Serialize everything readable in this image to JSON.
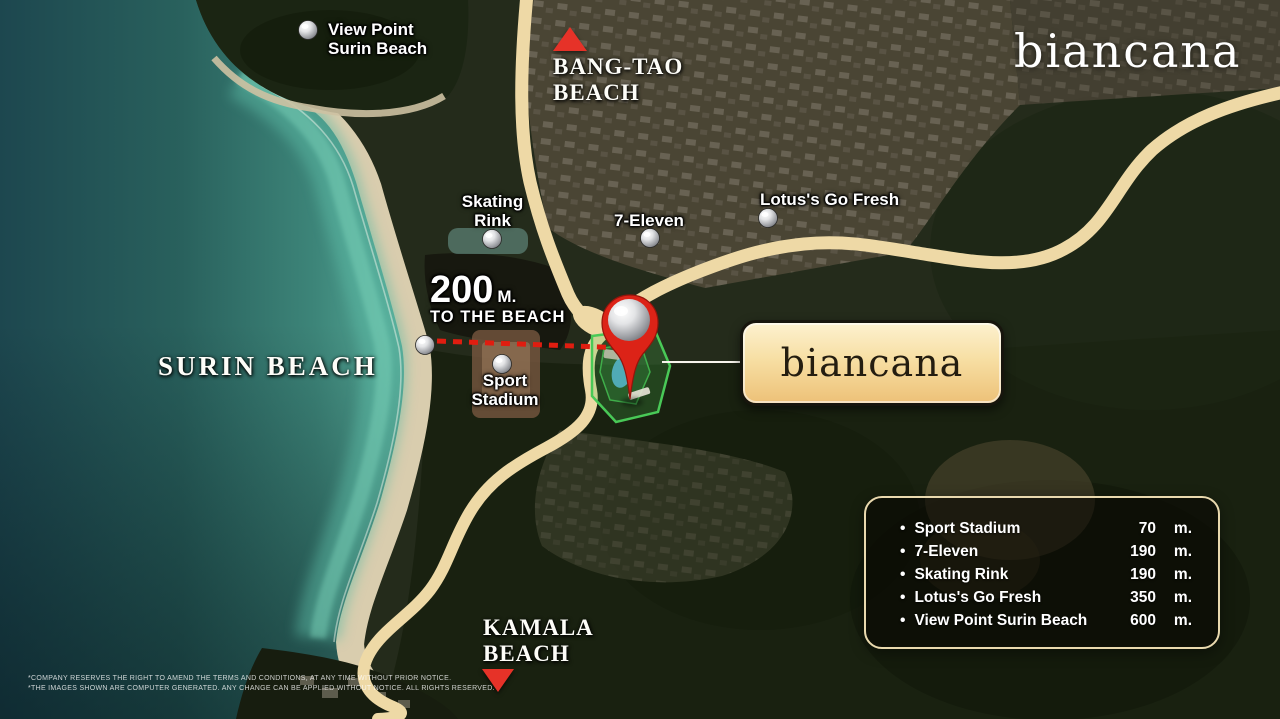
{
  "brand": {
    "logo_text": "biancana"
  },
  "map": {
    "labels": {
      "view_point": {
        "line1": "View Point",
        "line2": "Surin Beach"
      },
      "bang_tao": {
        "line1": "BANG-TAO",
        "line2": "BEACH"
      },
      "skating_rink": {
        "line1": "Skating",
        "line2": "Rink"
      },
      "seven_eleven": {
        "text": "7-Eleven"
      },
      "lotus": {
        "text": "Lotus's Go Fresh"
      },
      "surin_beach": {
        "text": "SURIN BEACH"
      },
      "sport_stadium": {
        "line1": "Sport",
        "line2": "Stadium"
      },
      "kamala": {
        "line1": "KAMALA",
        "line2": "BEACH"
      }
    },
    "beach_callout": {
      "value": "200",
      "unit": "M.",
      "caption": "TO THE BEACH"
    },
    "property_sign": {
      "text": "biancana"
    }
  },
  "distance_panel": {
    "items": [
      {
        "name": "Sport Stadium",
        "value": "70",
        "unit": "m."
      },
      {
        "name": "7-Eleven",
        "value": "190",
        "unit": "m."
      },
      {
        "name": "Skating Rink",
        "value": "190",
        "unit": "m."
      },
      {
        "name": "Lotus's Go Fresh",
        "value": "350",
        "unit": "m."
      },
      {
        "name": "View Point Surin Beach",
        "value": "600",
        "unit": "m."
      }
    ]
  },
  "disclaimer": {
    "line1": "*COMPANY RESERVES THE RIGHT TO AMEND THE TERMS AND CONDITIONS, AT ANY TIME WITHOUT PRIOR NOTICE.",
    "line2": "*THE IMAGES SHOWN ARE COMPUTER GENERATED. ANY CHANGE CAN BE APPLIED WITHOUT NOTICE. ALL RIGHTS RESERVED."
  },
  "colors": {
    "road": "#eed9a6",
    "accent_red": "#e02415",
    "panel_border": "#e9d9ae",
    "sign_gradient_top": "#fdf1cf",
    "sign_gradient_bottom": "#edc178",
    "ocean_deep": "#1d474f",
    "ocean_shallow": "#57ab98"
  }
}
